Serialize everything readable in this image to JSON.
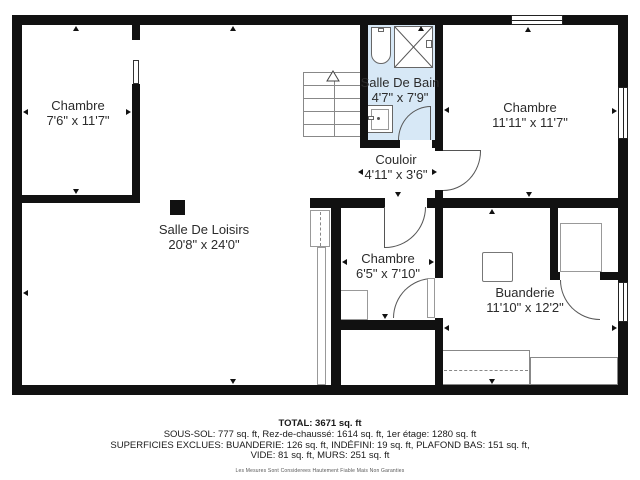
{
  "title": "Plan du sous-sol",
  "rooms": [
    {
      "id": "chambre-top-left",
      "name": "Chambre",
      "dimensions": "7'6\" x 11'7\""
    },
    {
      "id": "salle-de-bain",
      "name": "Salle De Bain",
      "dimensions": "4'7\" x 7'9\""
    },
    {
      "id": "chambre-top-right",
      "name": "Chambre",
      "dimensions": "11'11\" x 11'7\""
    },
    {
      "id": "couloir",
      "name": "Couloir",
      "dimensions": "4'11\" x 3'6\""
    },
    {
      "id": "salle-de-loisirs",
      "name": "Salle De Loisirs",
      "dimensions": "20'8\" x 24'0\""
    },
    {
      "id": "chambre-small",
      "name": "Chambre",
      "dimensions": "6'5\" x 7'10\""
    },
    {
      "id": "buanderie",
      "name": "Buanderie",
      "dimensions": "11'10\" x 12'2\""
    }
  ],
  "summary": {
    "total": "TOTAL: 3671 sq. ft",
    "floors": "SOUS-SOL: 777 sq. ft, Rez-de-chaussé: 1614 sq. ft, 1er étage: 1280 sq. ft",
    "exclusions_line1": "SUPERFICIES EXCLUES: BUANDERIE: 126 sq. ft, INDÉFINI: 19 sq. ft, PLAFOND BAS: 151 sq. ft,",
    "exclusions_line2": "VIDE: 81 sq. ft, MURS: 251 sq. ft",
    "disclaimer": "Les Mesures Sont Considerees Hautement Fiable Mais Non Garanties"
  },
  "colors": {
    "wall": "#111111",
    "bathroom_fill": "#d7e8f6",
    "text": "#2b2b2b"
  }
}
